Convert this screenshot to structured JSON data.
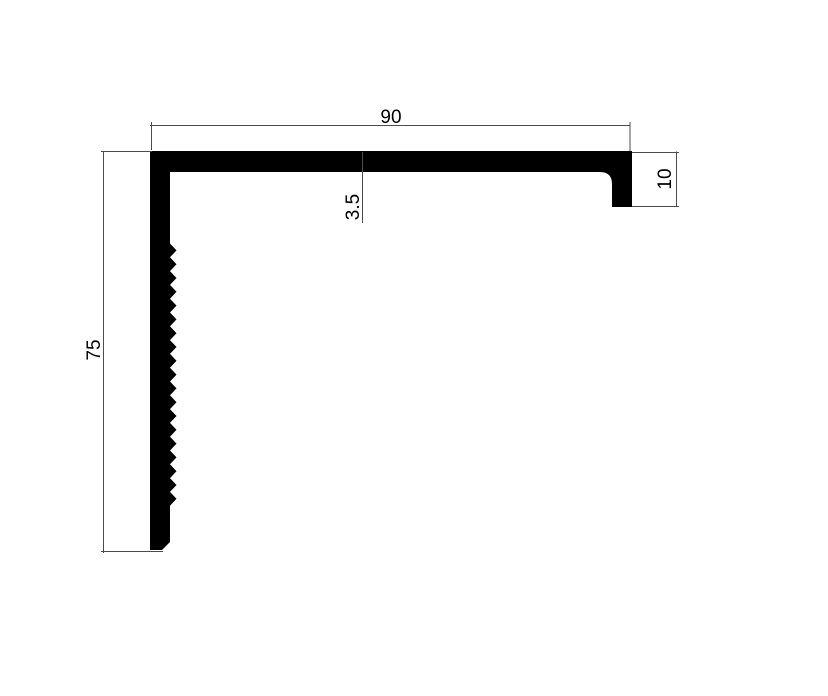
{
  "drawing": {
    "type": "technical-drawing",
    "subject": "L-shaped angle profile cross-section with serrated inner face and right lip",
    "background_color": "#ffffff",
    "profile_color": "#000000",
    "dimension_line_color": "#4c4c4c",
    "text_color": "#000000",
    "dimensions": {
      "top_width": "90",
      "left_height": "75",
      "wall_thickness": "3.5",
      "right_lip_height": "10"
    }
  }
}
